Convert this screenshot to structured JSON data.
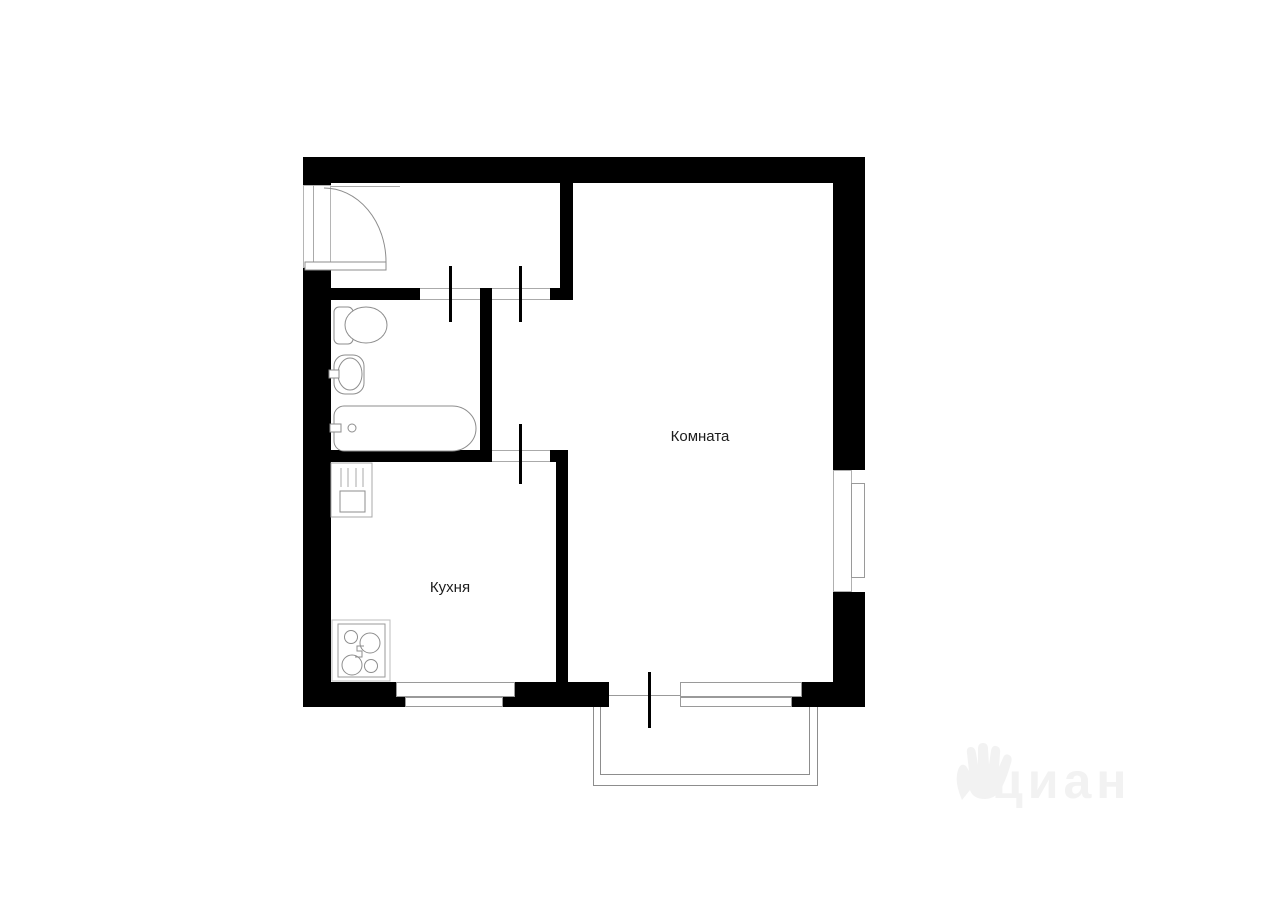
{
  "plan_type": "apartment-floor-plan",
  "rooms": {
    "living": {
      "label": "Комната"
    },
    "kitchen": {
      "label": "Кухня"
    }
  },
  "watermark": {
    "text": "циан"
  },
  "fixtures": {
    "entrance_door": "entrance-door",
    "toilet": "toilet",
    "bathroom_sink": "bathroom-sink",
    "bathtub": "bathtub",
    "kitchen_sink": "kitchen-sink",
    "stove": "stove",
    "balcony": "balcony",
    "right_wall_window": "window",
    "kitchen_window": "window",
    "balcony_door": "balcony-door"
  },
  "colors": {
    "background": "#ffffff",
    "wall": "#000000",
    "fixture_line": "#888888",
    "balcony_line": "#8d8d8d",
    "label_text": "#1c1c1c",
    "watermark": "#f2f2f2"
  }
}
